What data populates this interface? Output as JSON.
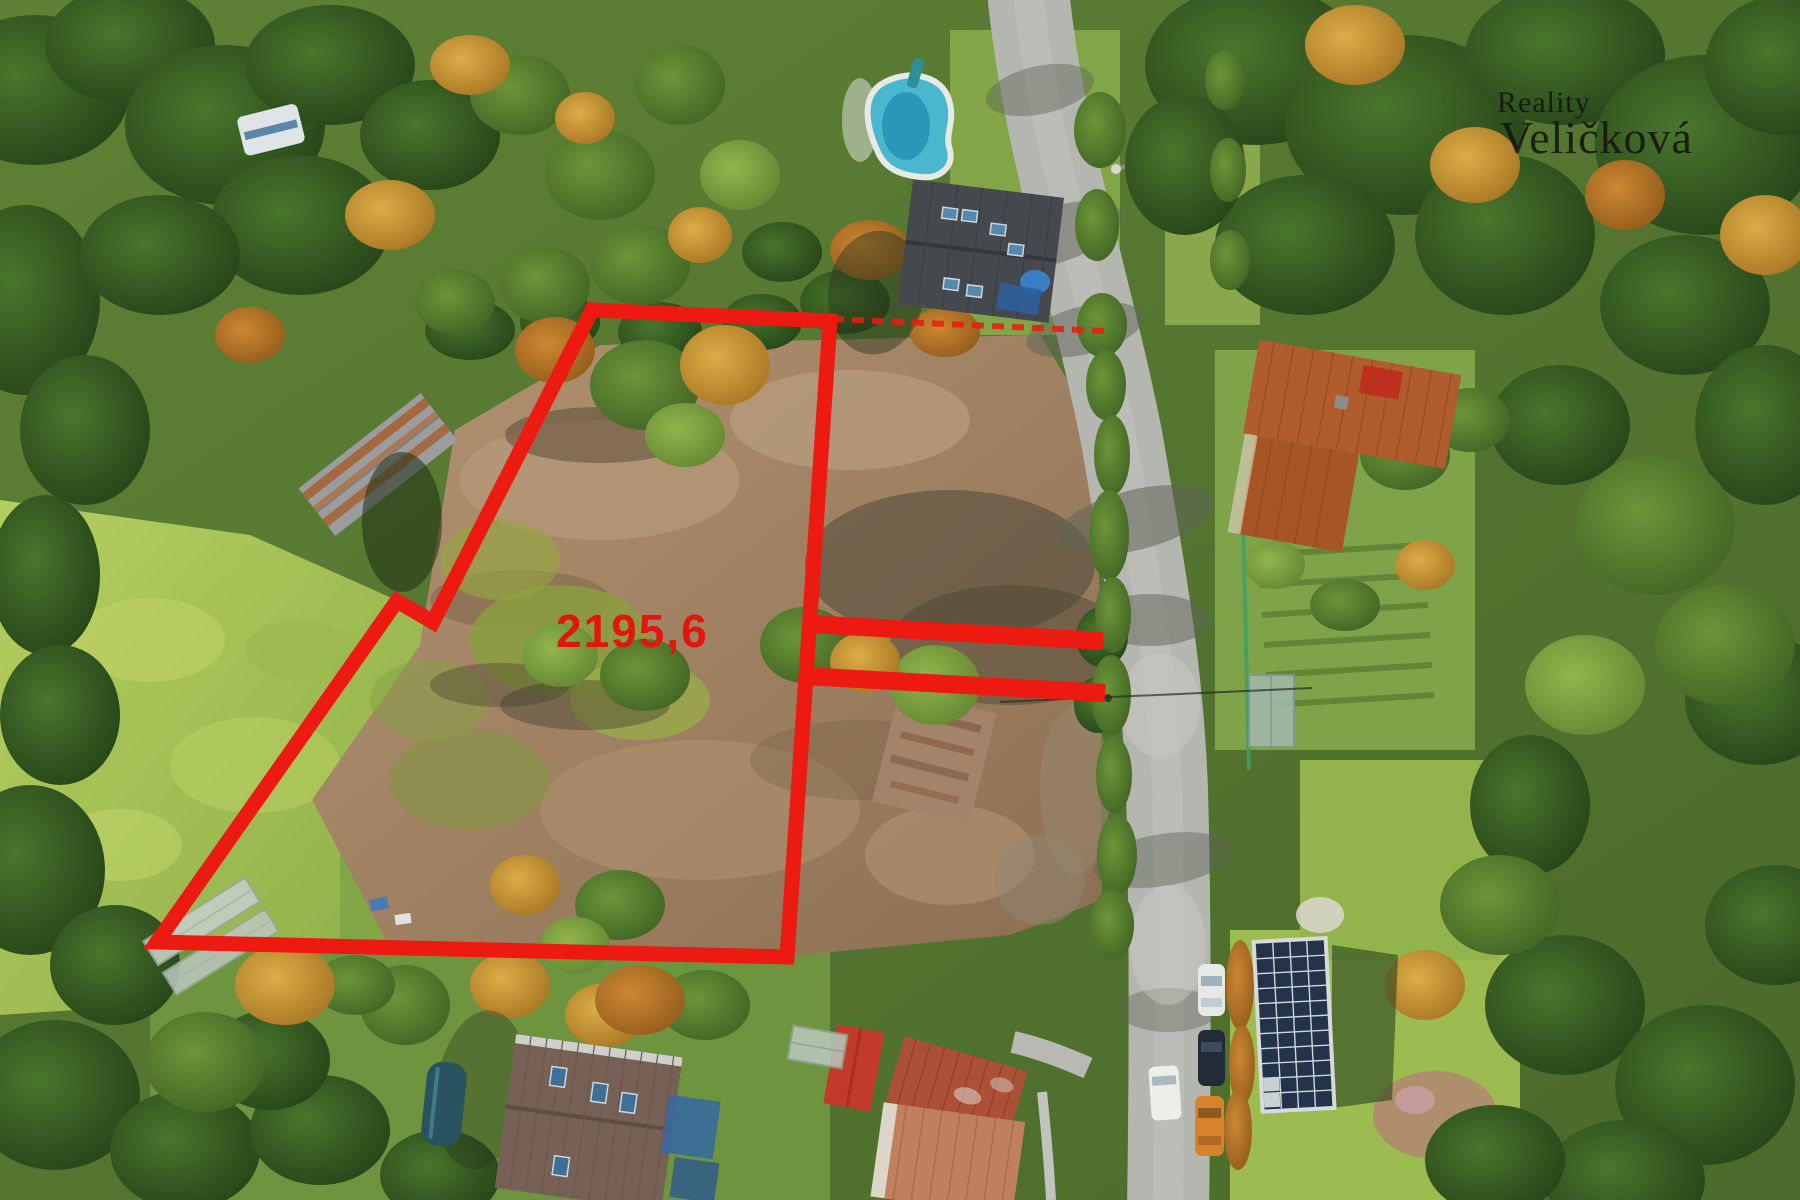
{
  "annotation": {
    "area_label": "2195,6",
    "outline_color": "#ec1a10",
    "label_color": "#e2160c"
  },
  "watermark": {
    "line1": "Reality",
    "line2": "Veličková",
    "color": "#16160e"
  }
}
